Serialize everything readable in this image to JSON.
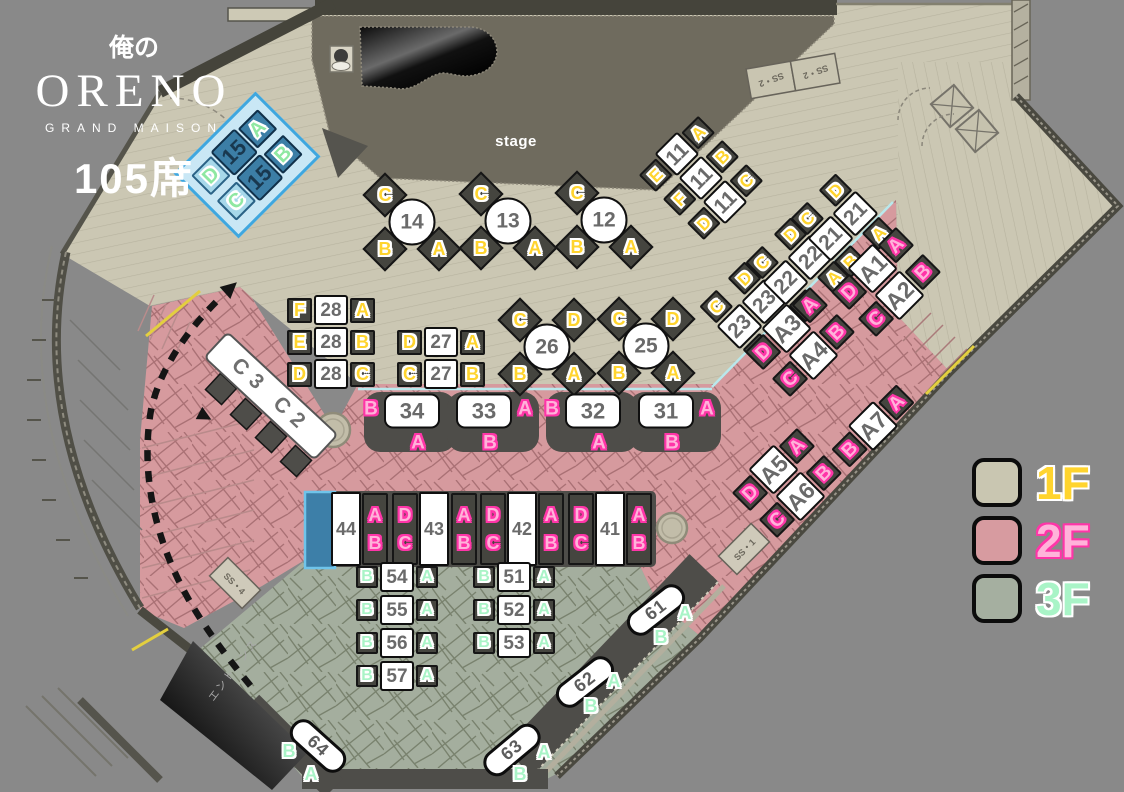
{
  "logo": {
    "kanji": "俺の",
    "name": "ORENO",
    "subtitle": "GRAND MAISON",
    "seats": "105席"
  },
  "misc": {
    "stage": "stage",
    "entrance": "エントランス",
    "ss2a": "SS・2",
    "ss2b": "SS・2",
    "ss4": "SS・4",
    "ss1": "SS・1"
  },
  "legend": {
    "items": [
      {
        "label": "1F",
        "swatch": "#c9c6b1",
        "color": "#ffd42e",
        "outline": "#ffffff"
      },
      {
        "label": "2F",
        "swatch": "#d79ba0",
        "color": "#ffb3da",
        "outline": "#ff35a8"
      },
      {
        "label": "3F",
        "swatch": "#a5afa0",
        "color": "#a9f4c7",
        "outline": "#ffffff"
      }
    ]
  },
  "theme": {
    "floor1": "#cbc7b3",
    "floor2": "#d69a9e",
    "floor3": "#a4ae9e",
    "stage": "#6f6b5e",
    "seat_dark": "#45453f",
    "letters_1f": "#ffd42e",
    "letters_2f": "#ffb3da",
    "letters_3f": "#a9f4c7",
    "highlight_blue": "#3fa7df"
  },
  "groups": [
    {
      "name": "table-15",
      "kind": "rowtable",
      "floor": "b",
      "cx": 247,
      "cy": 165,
      "rot": -45,
      "s": 28,
      "nw": 34,
      "nh": 34,
      "rows": [
        {
          "l": "D",
          "n": "15",
          "r": "A"
        },
        {
          "l": "C",
          "n": "15",
          "r": "B"
        }
      ]
    },
    {
      "name": "table-14",
      "kind": "circle",
      "floor": "1",
      "cx": 412,
      "cy": 222,
      "num": "14",
      "seats": [
        {
          "t": "C",
          "dx": -27,
          "dy": -27
        },
        {
          "t": "B",
          "dx": -27,
          "dy": 27
        },
        {
          "t": "A",
          "dx": 27,
          "dy": 27
        }
      ]
    },
    {
      "name": "table-13",
      "kind": "circle",
      "floor": "1",
      "cx": 508,
      "cy": 221,
      "num": "13",
      "seats": [
        {
          "t": "C",
          "dx": -27,
          "dy": -27
        },
        {
          "t": "B",
          "dx": -27,
          "dy": 27
        },
        {
          "t": "A",
          "dx": 27,
          "dy": 27
        }
      ]
    },
    {
      "name": "table-12",
      "kind": "circle",
      "floor": "1",
      "cx": 604,
      "cy": 220,
      "num": "12",
      "seats": [
        {
          "t": "C",
          "dx": -27,
          "dy": -27
        },
        {
          "t": "B",
          "dx": -27,
          "dy": 27
        },
        {
          "t": "A",
          "dx": 27,
          "dy": 27
        }
      ]
    },
    {
      "name": "table-11",
      "kind": "rowtable",
      "floor": "1",
      "cx": 701,
      "cy": 178,
      "rot": -45,
      "s": 24,
      "nw": 32,
      "nh": 32,
      "rows": [
        {
          "l": "E",
          "n": "11",
          "r": "A"
        },
        {
          "l": "F",
          "n": "11",
          "r": "B"
        },
        {
          "l": "D",
          "n": "11",
          "r": "C"
        }
      ]
    },
    {
      "name": "table-28",
      "kind": "rowtable",
      "floor": "1",
      "cx": 331,
      "cy": 342,
      "rot": 0,
      "s": 25,
      "nw": 34,
      "nh": 30,
      "rows": [
        {
          "l": "F",
          "n": "28",
          "r": "A"
        },
        {
          "l": "E",
          "n": "28",
          "r": "B"
        },
        {
          "l": "D",
          "n": "28",
          "r": "C"
        }
      ]
    },
    {
      "name": "table-27",
      "kind": "rowtable",
      "floor": "1",
      "cx": 441,
      "cy": 358,
      "rot": 0,
      "s": 25,
      "nw": 34,
      "nh": 30,
      "rows": [
        {
          "l": "D",
          "n": "27",
          "r": "A"
        },
        {
          "l": "C",
          "n": "27",
          "r": "B"
        }
      ]
    },
    {
      "name": "table-26",
      "kind": "circle",
      "floor": "1",
      "cx": 547,
      "cy": 347,
      "num": "26",
      "seats": [
        {
          "t": "C",
          "dx": -27,
          "dy": -27
        },
        {
          "t": "D",
          "dx": 27,
          "dy": -27
        },
        {
          "t": "B",
          "dx": -27,
          "dy": 27
        },
        {
          "t": "A",
          "dx": 27,
          "dy": 27
        }
      ]
    },
    {
      "name": "table-25",
      "kind": "circle",
      "floor": "1",
      "cx": 646,
      "cy": 346,
      "num": "25",
      "seats": [
        {
          "t": "C",
          "dx": -27,
          "dy": -27
        },
        {
          "t": "D",
          "dx": 27,
          "dy": -27
        },
        {
          "t": "B",
          "dx": -27,
          "dy": 27
        },
        {
          "t": "A",
          "dx": 27,
          "dy": 27
        }
      ]
    },
    {
      "name": "table-23",
      "kind": "pair",
      "floor": "1",
      "cx": 752,
      "cy": 314,
      "rot": -45,
      "num": "23",
      "top": [
        "C",
        "D"
      ],
      "bottom": [
        "B",
        "A"
      ]
    },
    {
      "name": "table-22",
      "kind": "pair",
      "floor": "1",
      "cx": 798,
      "cy": 270,
      "rot": -45,
      "num": "22",
      "top": [
        "C",
        "D"
      ],
      "bottom": [
        "B",
        "A"
      ]
    },
    {
      "name": "table-21",
      "kind": "pair",
      "floor": "1",
      "cx": 843,
      "cy": 226,
      "rot": -45,
      "num": "21",
      "top": [
        "C",
        "D"
      ],
      "bottom": [
        "B",
        "A"
      ]
    },
    {
      "name": "table-a1-a2",
      "kind": "rowtable",
      "floor": "2",
      "cx": 886,
      "cy": 282,
      "rot": -45,
      "s": 26,
      "nw": 36,
      "nh": 36,
      "rows": [
        {
          "l": "D",
          "n": "A1",
          "r": "A"
        },
        {
          "l": "C",
          "n": "A2",
          "r": "B"
        }
      ]
    },
    {
      "name": "table-a3-a4",
      "kind": "rowtable",
      "floor": "2",
      "cx": 800,
      "cy": 342,
      "rot": -45,
      "s": 26,
      "nw": 36,
      "nh": 36,
      "rows": [
        {
          "l": "D",
          "n": "A3",
          "r": "A"
        },
        {
          "l": "C",
          "n": "A4",
          "r": "B"
        }
      ]
    },
    {
      "name": "table-a5-a6",
      "kind": "rowtable",
      "floor": "2",
      "cx": 787,
      "cy": 483,
      "rot": -45,
      "s": 26,
      "nw": 36,
      "nh": 36,
      "rows": [
        {
          "l": "D",
          "n": "A5",
          "r": "A"
        },
        {
          "l": "C",
          "n": "A6",
          "r": "B"
        }
      ]
    },
    {
      "name": "table-a7",
      "kind": "rowtable",
      "floor": "2",
      "cx": 873,
      "cy": 426,
      "rot": -45,
      "s": 26,
      "nw": 36,
      "nh": 36,
      "rows": [
        {
          "l": "B",
          "n": "A7",
          "r": "A"
        }
      ]
    },
    {
      "name": "table-34",
      "kind": "booth",
      "floor": "2",
      "cx": 412,
      "cy": 411,
      "num": "34",
      "side": "L",
      "sl": "B",
      "bl": "A"
    },
    {
      "name": "table-33",
      "kind": "booth",
      "floor": "2",
      "cx": 484,
      "cy": 411,
      "num": "33",
      "side": "R",
      "sl": "A",
      "bl": "B"
    },
    {
      "name": "table-32",
      "kind": "booth",
      "floor": "2",
      "cx": 593,
      "cy": 411,
      "num": "32",
      "side": "L",
      "sl": "B",
      "bl": "A"
    },
    {
      "name": "table-31",
      "kind": "booth",
      "floor": "2",
      "cx": 666,
      "cy": 411,
      "num": "31",
      "side": "R",
      "sl": "A",
      "bl": "B"
    },
    {
      "name": "table-44",
      "kind": "vnum",
      "floor": "2",
      "cx": 346,
      "cy": 529,
      "num": "44"
    },
    {
      "name": "seats-44-ab",
      "kind": "vseats",
      "floor": "2",
      "cx": 375,
      "cy": 529,
      "letters": [
        "A",
        "B"
      ]
    },
    {
      "name": "seats-43-dc",
      "kind": "vseats",
      "floor": "2",
      "cx": 405,
      "cy": 529,
      "letters": [
        "D",
        "C"
      ]
    },
    {
      "name": "table-43",
      "kind": "vnum",
      "floor": "2",
      "cx": 434,
      "cy": 529,
      "num": "43"
    },
    {
      "name": "seats-43-ab",
      "kind": "vseats",
      "floor": "2",
      "cx": 464,
      "cy": 529,
      "letters": [
        "A",
        "B"
      ]
    },
    {
      "name": "seats-42-dc",
      "kind": "vseats",
      "floor": "2",
      "cx": 493,
      "cy": 529,
      "letters": [
        "D",
        "C"
      ]
    },
    {
      "name": "table-42",
      "kind": "vnum",
      "floor": "2",
      "cx": 522,
      "cy": 529,
      "num": "42"
    },
    {
      "name": "seats-42-ab",
      "kind": "vseats",
      "floor": "2",
      "cx": 551,
      "cy": 529,
      "letters": [
        "A",
        "B"
      ]
    },
    {
      "name": "seats-41-dc",
      "kind": "vseats",
      "floor": "2",
      "cx": 581,
      "cy": 529,
      "letters": [
        "D",
        "C"
      ]
    },
    {
      "name": "table-41",
      "kind": "vnum",
      "floor": "2",
      "cx": 610,
      "cy": 529,
      "num": "41"
    },
    {
      "name": "seats-41-ab",
      "kind": "vseats",
      "floor": "2",
      "cx": 639,
      "cy": 529,
      "letters": [
        "A",
        "B"
      ]
    },
    {
      "name": "table-54",
      "kind": "rowtable",
      "floor": "3",
      "cx": 397,
      "cy": 577,
      "rot": 0,
      "s": 22,
      "nw": 34,
      "nh": 30,
      "rows": [
        {
          "l": "B",
          "n": "54",
          "r": "A"
        }
      ]
    },
    {
      "name": "table-55",
      "kind": "rowtable",
      "floor": "3",
      "cx": 397,
      "cy": 610,
      "rot": 0,
      "s": 22,
      "nw": 34,
      "nh": 30,
      "rows": [
        {
          "l": "B",
          "n": "55",
          "r": "A"
        }
      ]
    },
    {
      "name": "table-56",
      "kind": "rowtable",
      "floor": "3",
      "cx": 397,
      "cy": 643,
      "rot": 0,
      "s": 22,
      "nw": 34,
      "nh": 30,
      "rows": [
        {
          "l": "B",
          "n": "56",
          "r": "A"
        }
      ]
    },
    {
      "name": "table-57",
      "kind": "rowtable",
      "floor": "3",
      "cx": 397,
      "cy": 676,
      "rot": 0,
      "s": 22,
      "nw": 34,
      "nh": 30,
      "rows": [
        {
          "l": "B",
          "n": "57",
          "r": "A"
        }
      ]
    },
    {
      "name": "table-51",
      "kind": "rowtable",
      "floor": "3",
      "cx": 514,
      "cy": 577,
      "rot": 0,
      "s": 22,
      "nw": 34,
      "nh": 30,
      "rows": [
        {
          "l": "B",
          "n": "51",
          "r": "A"
        }
      ]
    },
    {
      "name": "table-52",
      "kind": "rowtable",
      "floor": "3",
      "cx": 514,
      "cy": 610,
      "rot": 0,
      "s": 22,
      "nw": 34,
      "nh": 30,
      "rows": [
        {
          "l": "B",
          "n": "52",
          "r": "A"
        }
      ]
    },
    {
      "name": "table-53",
      "kind": "rowtable",
      "floor": "3",
      "cx": 514,
      "cy": 643,
      "rot": 0,
      "s": 22,
      "nw": 34,
      "nh": 30,
      "rows": [
        {
          "l": "B",
          "n": "53",
          "r": "A"
        }
      ]
    },
    {
      "name": "table-61",
      "kind": "tag",
      "floor": "3",
      "cx": 656,
      "cy": 610,
      "rot": -38,
      "num": "61",
      "letters": [
        {
          "t": "A",
          "dx": 29,
          "dy": 3
        },
        {
          "t": "B",
          "dx": 5,
          "dy": 27
        }
      ]
    },
    {
      "name": "table-62",
      "kind": "tag",
      "floor": "3",
      "cx": 585,
      "cy": 682,
      "rot": -38,
      "num": "62",
      "letters": [
        {
          "t": "A",
          "dx": 29,
          "dy": -1
        },
        {
          "t": "B",
          "dx": 6,
          "dy": 24
        }
      ]
    },
    {
      "name": "table-63",
      "kind": "tag",
      "floor": "3",
      "cx": 512,
      "cy": 750,
      "rot": -40,
      "num": "63",
      "letters": [
        {
          "t": "A",
          "dx": 32,
          "dy": 2
        },
        {
          "t": "B",
          "dx": 8,
          "dy": 24
        }
      ]
    },
    {
      "name": "table-64",
      "kind": "tag",
      "floor": "3",
      "cx": 318,
      "cy": 746,
      "rot": 42,
      "num": "64",
      "letters": [
        {
          "t": "B",
          "dx": -29,
          "dy": 5
        },
        {
          "t": "A",
          "dx": -7,
          "dy": 28
        }
      ]
    },
    {
      "name": "counter-c3-c2",
      "kind": "counter",
      "floor": "2",
      "cx": 271,
      "cy": 396,
      "rot": 43,
      "num": "C3 C2"
    }
  ]
}
